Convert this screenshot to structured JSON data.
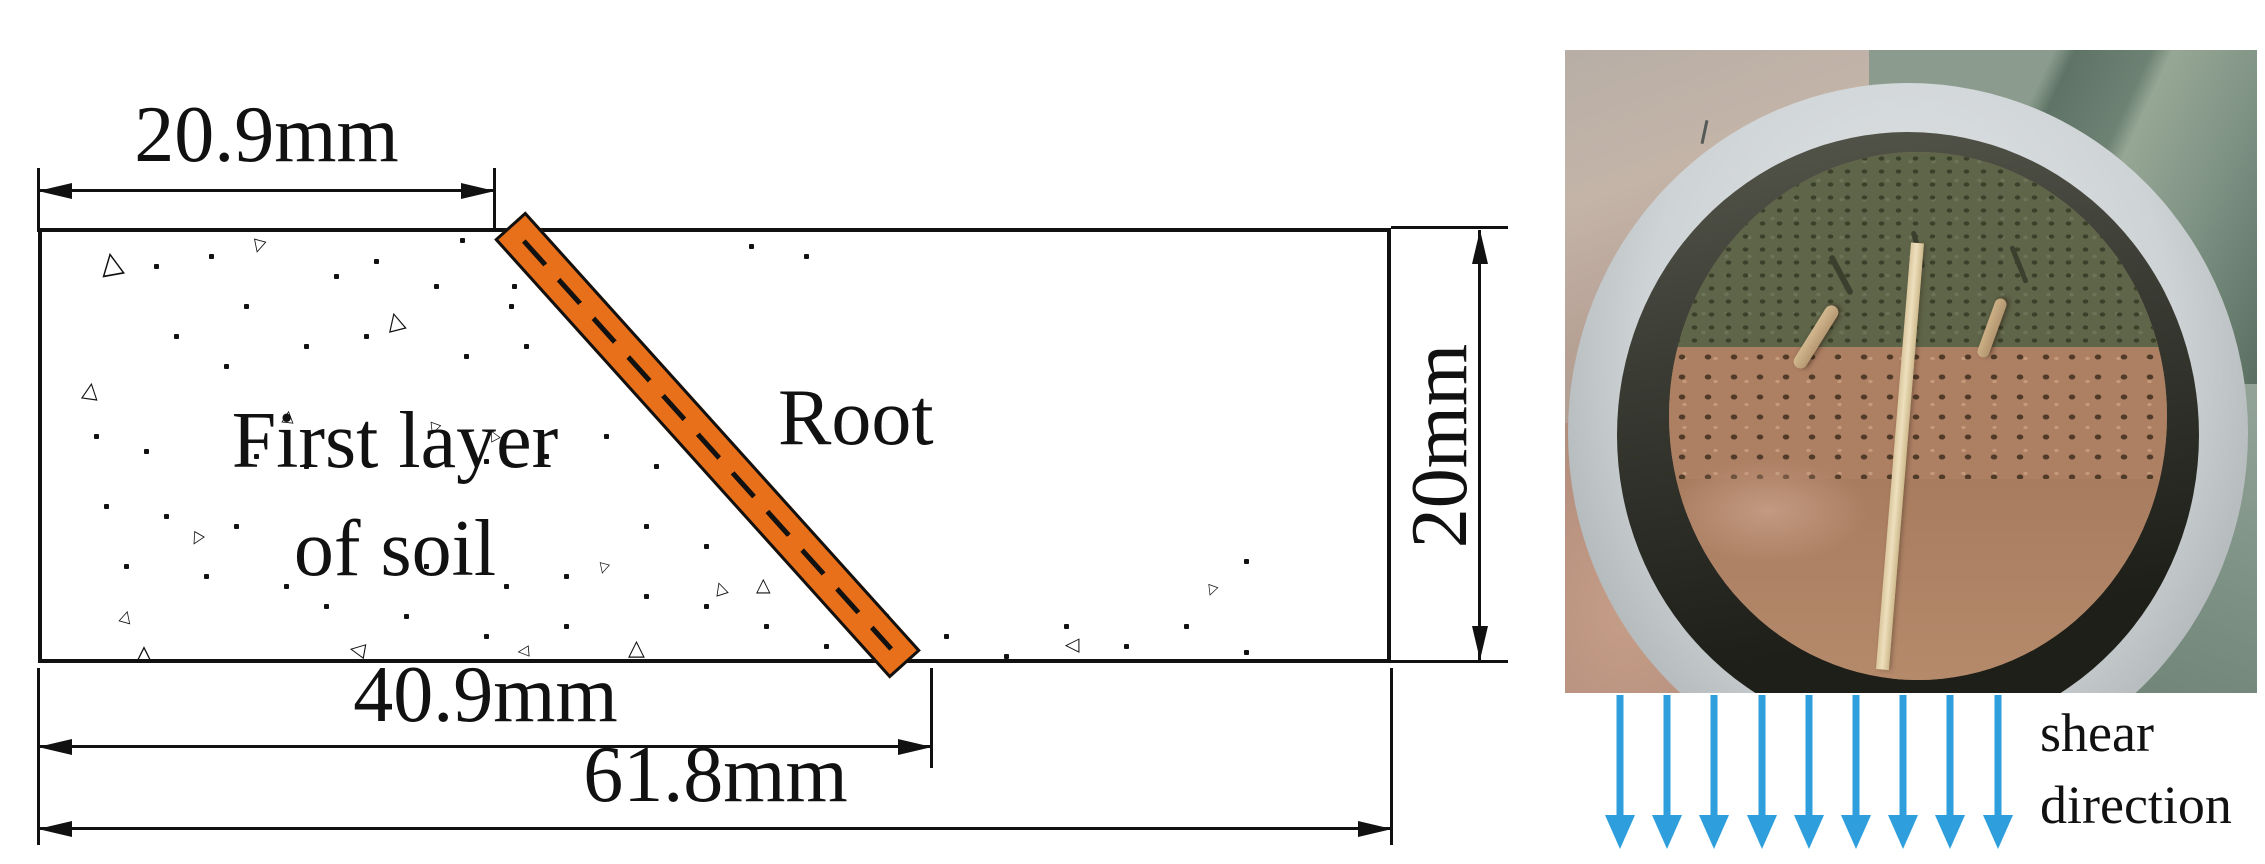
{
  "diagram": {
    "soil_label": {
      "line1": "First layer",
      "line2": "of soil"
    },
    "root_label": "Root",
    "dim_top": "20.9mm",
    "dim_bottom_inner": "40.9mm",
    "dim_bottom_outer": "61.8mm",
    "dim_right": "20mm",
    "texture": {
      "triangles": [
        {
          "x": 58,
          "y": 16,
          "s": 30,
          "r": -10
        },
        {
          "x": 40,
          "y": 148,
          "s": 22,
          "r": 8
        },
        {
          "x": 210,
          "y": 6,
          "s": 17,
          "r": 195
        },
        {
          "x": 344,
          "y": 76,
          "s": 24,
          "r": -14
        },
        {
          "x": 240,
          "y": 176,
          "s": 16,
          "r": 6
        },
        {
          "x": 386,
          "y": 190,
          "s": 15,
          "r": 200
        },
        {
          "x": 446,
          "y": 196,
          "s": 14,
          "r": -28
        },
        {
          "x": 148,
          "y": 300,
          "s": 16,
          "r": 210
        },
        {
          "x": 556,
          "y": 330,
          "s": 14,
          "r": 195
        },
        {
          "x": 78,
          "y": 376,
          "s": 16,
          "r": 15
        },
        {
          "x": 92,
          "y": 410,
          "s": 26,
          "r": 0
        },
        {
          "x": 306,
          "y": 408,
          "s": 20,
          "r": -80
        },
        {
          "x": 586,
          "y": 406,
          "s": 22,
          "r": 0
        },
        {
          "x": 672,
          "y": 348,
          "s": 17,
          "r": -18
        },
        {
          "x": 714,
          "y": 344,
          "s": 19,
          "r": 0
        },
        {
          "x": 1022,
          "y": 404,
          "s": 19,
          "r": -90
        },
        {
          "x": 1164,
          "y": 352,
          "s": 14,
          "r": 200
        },
        {
          "x": 475,
          "y": 412,
          "s": 15,
          "r": -95
        }
      ],
      "dots": [
        [
          112,
          32
        ],
        [
          167,
          22
        ],
        [
          202,
          72
        ],
        [
          292,
          42
        ],
        [
          332,
          27
        ],
        [
          392,
          52
        ],
        [
          418,
          6
        ],
        [
          470,
          52
        ],
        [
          467,
          72
        ],
        [
          522,
          62
        ],
        [
          132,
          102
        ],
        [
          182,
          132
        ],
        [
          262,
          112
        ],
        [
          322,
          102
        ],
        [
          422,
          122
        ],
        [
          482,
          112
        ],
        [
          52,
          202
        ],
        [
          102,
          217
        ],
        [
          212,
          222
        ],
        [
          262,
          232
        ],
        [
          442,
          227
        ],
        [
          502,
          222
        ],
        [
          562,
          202
        ],
        [
          612,
          232
        ],
        [
          62,
          272
        ],
        [
          122,
          282
        ],
        [
          192,
          292
        ],
        [
          602,
          292
        ],
        [
          662,
          312
        ],
        [
          82,
          332
        ],
        [
          162,
          342
        ],
        [
          242,
          352
        ],
        [
          382,
          332
        ],
        [
          462,
          352
        ],
        [
          522,
          342
        ],
        [
          602,
          362
        ],
        [
          662,
          372
        ],
        [
          722,
          392
        ],
        [
          782,
          412
        ],
        [
          842,
          382
        ],
        [
          902,
          402
        ],
        [
          962,
          422
        ],
        [
          1022,
          392
        ],
        [
          1082,
          412
        ],
        [
          1142,
          392
        ],
        [
          1202,
          418
        ],
        [
          1252,
          428
        ],
        [
          522,
          392
        ],
        [
          442,
          402
        ],
        [
          362,
          382
        ],
        [
          282,
          372
        ],
        [
          707,
          12
        ],
        [
          762,
          22
        ],
        [
          1202,
          327
        ]
      ]
    }
  },
  "photo": {
    "shear_label": {
      "line1": "shear",
      "line2": "direction"
    },
    "arrow_count": 9
  },
  "colors": {
    "line": "#111111",
    "root_fill": "#e8701b",
    "arrow_blue": "#2e9fdc",
    "soil_olive": "#5f6549",
    "soil_clump": "#ad7f63",
    "soil_smooth": "#ab8164",
    "stick": "#eee0bd"
  }
}
